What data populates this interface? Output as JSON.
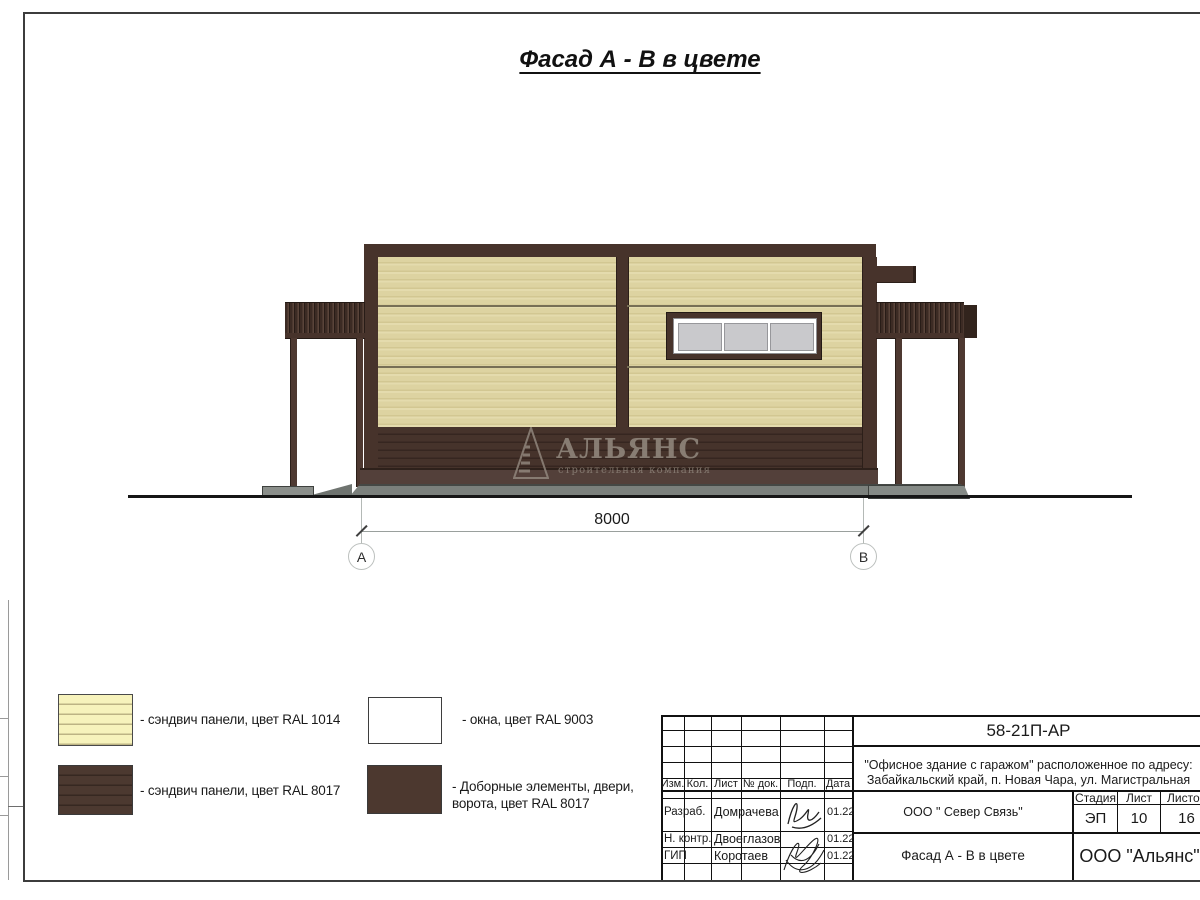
{
  "title": {
    "text": "Фасад А - В в цвете"
  },
  "watermark": {
    "name": "АЛЬЯНС",
    "subtitle": "строительная компания"
  },
  "dimension": {
    "value": "8000",
    "axis_left": "А",
    "axis_right": "В"
  },
  "legend": {
    "items": [
      {
        "swatch": "cream-striped-swatch",
        "label": "- сэндвич панели, цвет RAL 1014"
      },
      {
        "swatch": "brown-striped-swatch",
        "label": "- сэндвич панели, цвет RAL 8017"
      },
      {
        "swatch": "white-swatch",
        "label": "- окна, цвет RAL 9003"
      },
      {
        "swatch": "brown-solid-swatch",
        "label": "- Доборные элементы, двери,",
        "label2": "ворота, цвет RAL 8017"
      }
    ]
  },
  "tb": {
    "doc_number": "58-21П-АР",
    "project_line1": "\"Офисное здание с гаражом\" расположенное по адресу:",
    "project_line2": "Забайкальский край, п. Новая Чара, ул. Магистральная",
    "cols": [
      "Изм.",
      "Кол.",
      "Лист",
      "№ док.",
      "Подп.",
      "Дата"
    ],
    "rows": [
      {
        "role": "Разраб.",
        "name": "Домрачева",
        "date": "01.22"
      },
      {
        "role": "Н. контр.",
        "name": "Двоеглазов",
        "date": "01.22"
      },
      {
        "role": "ГИП",
        "name": "Коротаев",
        "date": "01.22"
      }
    ],
    "org_middle": "ООО \" Север Связь\"",
    "stage_label": "Стадия",
    "sheet_label": "Лист",
    "sheets_label": "Листов",
    "stage": "ЭП",
    "sheet": "10",
    "sheets": "16",
    "drawing_name": "Фасад А - В в цвете",
    "org_right": "ООО \"Альянс\""
  },
  "colors": {
    "ral_1014_panel": "#ddd3a1",
    "ral_8017_elements": "#47332b",
    "ral_9003_window": "#ffffff",
    "legend_ral_1014": "#f7f3bc",
    "legend_ral_8017": "#4c3930",
    "concrete_apron": "#7b807c",
    "window_glass": "#c9c9cc"
  }
}
